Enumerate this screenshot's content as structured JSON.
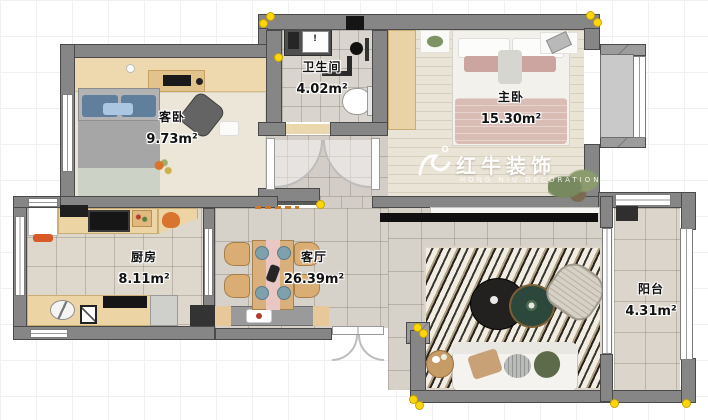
{
  "watermark": {
    "brand": "红牛装饰",
    "subtitle": "HONG NIU DECORATION"
  },
  "rooms": [
    {
      "name": "客卧",
      "area": "9.73m²"
    },
    {
      "name": "卫生间",
      "area": "4.02m²"
    },
    {
      "name": "主卧",
      "area": "15.30m²"
    },
    {
      "name": "厨房",
      "area": "8.11m²"
    },
    {
      "name": "客厅",
      "area": "26.39m²"
    },
    {
      "name": "阳台",
      "area": "4.31m²"
    }
  ],
  "icons": {
    "sink_alert": "!"
  },
  "colors": {
    "wall": "#868686",
    "wall_edge": "#4a4a4a",
    "selection_handle": "#ffd60a",
    "wood_counter": "#ecd4a4",
    "gray_tile": "#d5d0c8",
    "accent_orange": "#d8742e",
    "pillow_blue": "#5f7f9d",
    "blanket_pink": "#d9bcb4"
  }
}
